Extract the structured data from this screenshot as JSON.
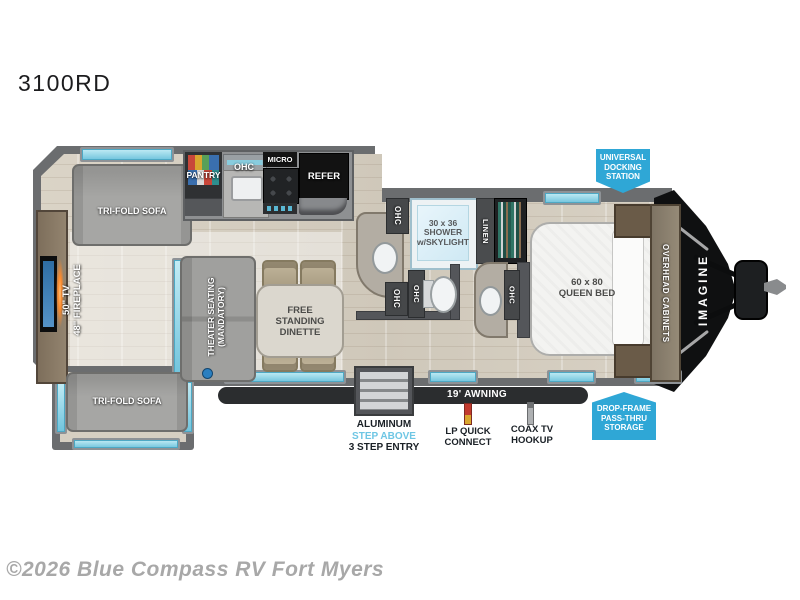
{
  "title": "3100RD",
  "watermark": "©2026 Blue Compass RV Fort Myers",
  "colors": {
    "callout_blue": "#2fa7d6",
    "window_teal": "#8fd8e8",
    "step_above_blue": "#6ec6e4",
    "awning_dark": "#2b2d2f",
    "fireplace_glow": "#ff8a2a",
    "tv_screen_blue": "#3f7fb5"
  },
  "plan": {
    "sofa_top": "TRI-FOLD SOFA",
    "sofa_bottom": "TRI-FOLD SOFA",
    "tv_label": "50\" TV",
    "fireplace_label": "48\" FIREPLACE",
    "theater": [
      "THEATER SEATING",
      "(MANDATORY)"
    ],
    "dinette": [
      "FREE",
      "STANDING",
      "DINETTE"
    ],
    "pantry": "PANTRY",
    "micro": "MICRO",
    "refer": "REFER",
    "ohc": "OHC",
    "shower": [
      "30 x 36",
      "SHOWER",
      "w/SKYLIGHT"
    ],
    "linen": "LINEN",
    "queen_bed": [
      "60 x 80",
      "QUEEN BED"
    ],
    "overhead_cabinets": "OVERHEAD CABINETS",
    "brand": "IMAGINE"
  },
  "callouts": {
    "docking": [
      "UNIVERSAL",
      "DOCKING",
      "STATION"
    ],
    "storage": [
      "DROP-FRAME",
      "PASS-THRU",
      "STORAGE"
    ]
  },
  "exterior": {
    "awning": "19' AWNING",
    "entry": [
      "ALUMINUM",
      "STEP ABOVE",
      "3 STEP ENTRY"
    ],
    "lp": [
      "LP QUICK",
      "CONNECT"
    ],
    "coax": [
      "COAX TV",
      "HOOKUP"
    ]
  }
}
